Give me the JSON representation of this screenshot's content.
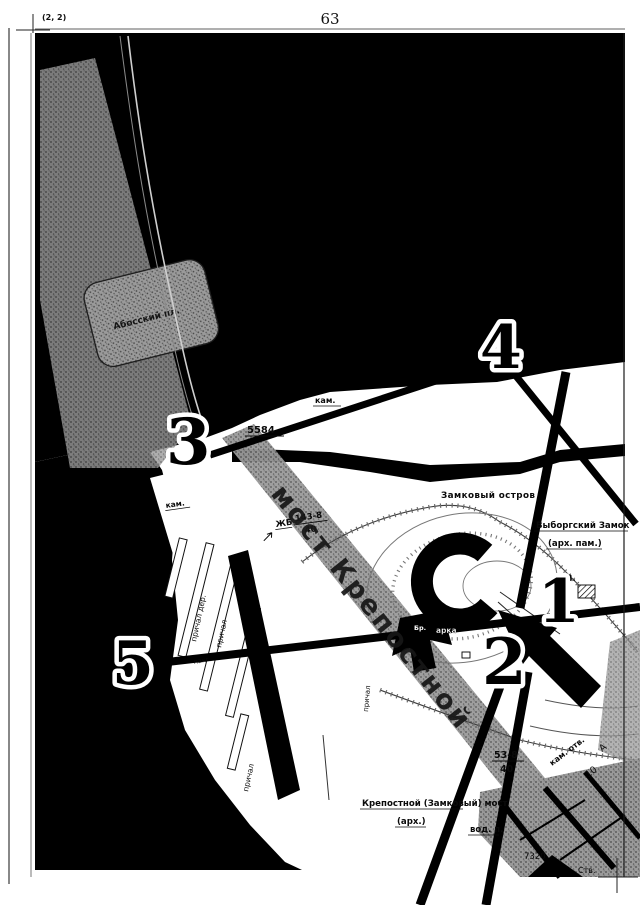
{
  "page": {
    "margin_label": "(2, 2)",
    "page_number": "63"
  },
  "markers": {
    "m1": "1",
    "m2": "2",
    "m3": "3",
    "m4": "4",
    "m5": "5"
  },
  "labels": {
    "kam_top": "кам.",
    "survey_5584": "5584",
    "zhb": "ЖБ",
    "frac1_num": "143-8",
    "frac1_den": "40",
    "island": "Замковый остров",
    "castle_name": "Выборгский Замок",
    "castle_note": "(арх. пам.)",
    "v_point": "В.",
    "arka": "арка",
    "br": "Бр.",
    "bridge_big": "мост Крепостной",
    "kam_left": "кам.",
    "prichal_der": "причал дер.",
    "prichal_a": "причал",
    "pakg": "пакг.",
    "prichal_b": "причал",
    "prichal_c": "причал",
    "frac2_num": "53-8",
    "frac2_den": "40",
    "kam_otv": "кам. отв.",
    "n10": "10",
    "letter_a": "А",
    "vod_p": "вод. п.",
    "n7320": "7320",
    "stv": "Ств.",
    "bottom_bridge_1": "Крепостной (Замковый) мост",
    "bottom_bridge_2": "(арх.)",
    "plaza": "Абосский пл."
  },
  "colors": {
    "ink": "#000000",
    "paper": "#ffffff",
    "stipple_gray": "#9a9a9a",
    "contour_gray": "#777777"
  }
}
